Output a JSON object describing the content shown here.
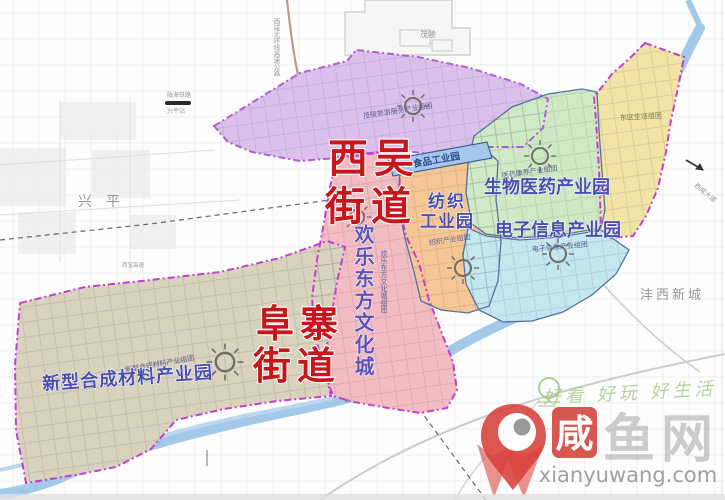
{
  "districts": {
    "xiwu_l1": "西吴",
    "xiwu_l2": "街道",
    "fuzhai_l1": "阜寨",
    "fuzhai_l2": "街道"
  },
  "zones": {
    "maoling": {
      "cluster": "茂陵旅游服务产业组团"
    },
    "food": {
      "label": "食品工业园"
    },
    "textile": {
      "l1": "纺织",
      "l2": "工业园",
      "cluster": "纺织产业组团"
    },
    "biomed": {
      "label": "生物医药产业园",
      "cluster": "医药康养产业组团"
    },
    "einfo": {
      "label": "电子信息产业园",
      "cluster": "电子信息产业组团"
    },
    "east": {
      "label": "东区生活组团"
    },
    "materials": {
      "label": "新型合成材料产业园",
      "cluster": "新型合成材料产业组团"
    },
    "happy": {
      "label": "欢乐东方文化城",
      "cluster": "欢乐东方文化城组团"
    }
  },
  "places": {
    "xingping": "兴平",
    "fengxi": "沣西新城",
    "maoling": "茂陵",
    "railway_name": "陇海铁路",
    "station": "兴平站",
    "expressway": "西咸北环线高速公路",
    "xibao": "西宝高速",
    "road_se": "西咸大道"
  },
  "watermark": {
    "slogan": "好看 好玩 好生活",
    "logo_char": "咸",
    "logo_suffix": "鱼网",
    "url": "xianyuwang.com"
  },
  "colors": {
    "boundary_magenta": "#c33fd1",
    "district_red": "#c5171c",
    "label_indigo": "#4a4fae",
    "zone_purple": "#dcc0ec",
    "zone_pink": "#f3bcc3",
    "zone_orange": "#f6c795",
    "zone_banner_blue": "#a6c6ea",
    "zone_green": "#cfe9c4",
    "zone_cyan": "#c3e7ee",
    "zone_yellow": "#f2e4a4",
    "zone_tan": "#d9d2bd",
    "river_blue": "#a3c9e9"
  }
}
